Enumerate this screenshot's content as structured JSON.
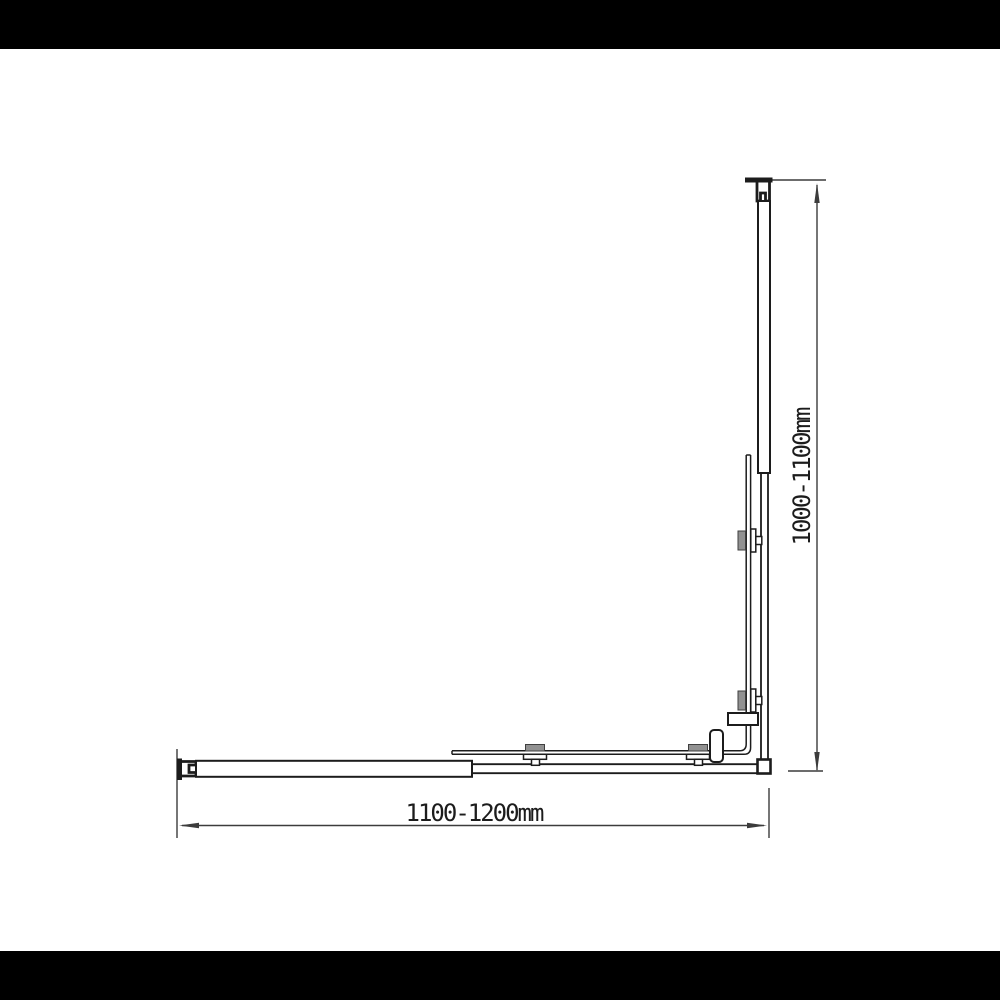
{
  "drawing": {
    "width_dimension": "1100-1200mm",
    "height_dimension": "1000-1100mm",
    "colors": {
      "line": "#1c1c1c",
      "dim": "#3c3c3c",
      "clamp": "#919191",
      "fill": "#ffffff"
    }
  }
}
